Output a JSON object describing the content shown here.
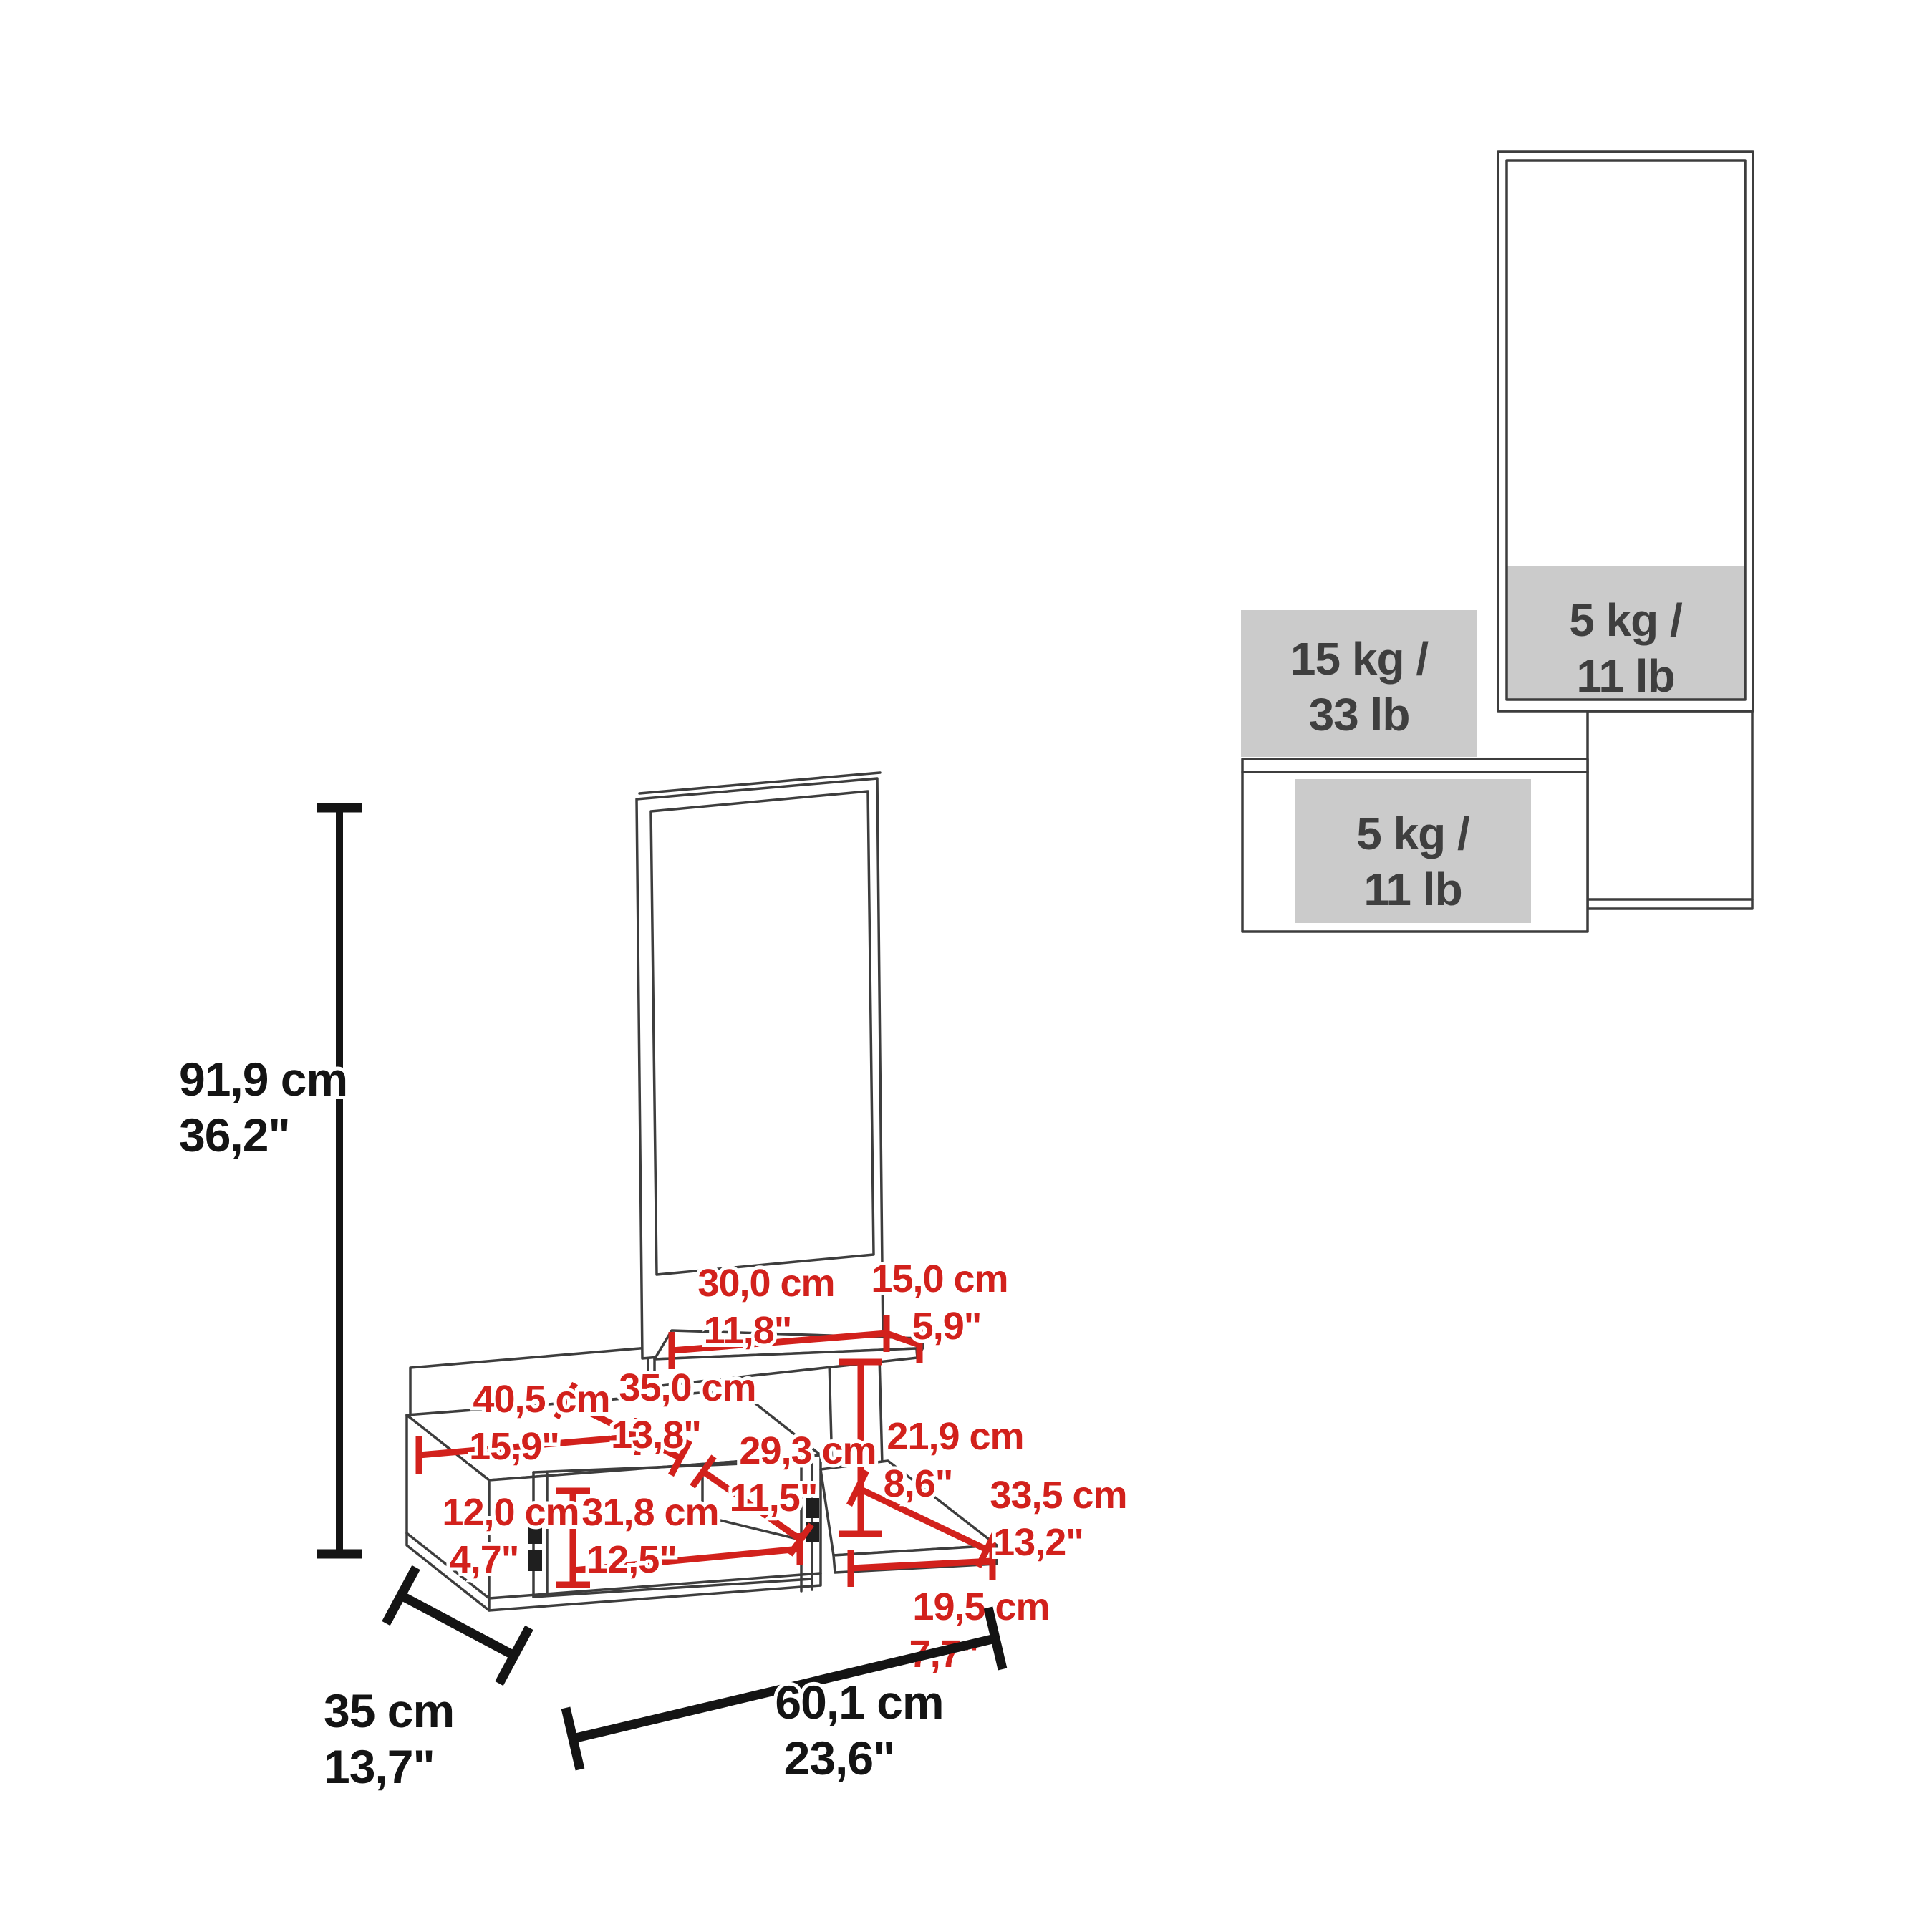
{
  "diagram_type": "furniture dimension diagram",
  "colors": {
    "dimension_red": "#d2211c",
    "outline_gray": "#3d3d3d",
    "dimension_black": "#141414",
    "capacity_gray": "#cbcbcb",
    "capacity_text": "#3f3f3f"
  },
  "main_view": {
    "overall_dimensions": {
      "height": {
        "cm": "91,9 cm",
        "in": "36,2\""
      },
      "depth": {
        "cm": "35 cm",
        "in": "13,7\""
      },
      "width": {
        "cm": "60,1 cm",
        "in": "23,6\""
      }
    },
    "partial_dimensions": {
      "shelf_left": {
        "cm": "30,0 cm",
        "in": "11,8\""
      },
      "shelf_right": {
        "cm": "15,0 cm",
        "in": "5,9\""
      },
      "top_width": {
        "cm": "40,5 cm",
        "in": "15,9\""
      },
      "top_depth": {
        "cm": "35,0 cm",
        "in": "13,8\""
      },
      "interior_depth": {
        "cm": "29,3 cm",
        "in": "11,5\""
      },
      "shelf_clearance": {
        "cm": "21,9 cm",
        "in": "8,6\""
      },
      "base_depth": {
        "cm": "33,5 cm",
        "in": "13,2\""
      },
      "door_height": {
        "cm": "12,0 cm",
        "in": "4,7\""
      },
      "interior_width": {
        "cm": "31,8 cm",
        "in": "12,5\""
      },
      "base_width": {
        "cm": "19,5 cm",
        "in": "7,7\""
      }
    }
  },
  "load_view": {
    "mirror_shelf_capacity": {
      "line1": "5 kg /",
      "line2": "11 lb"
    },
    "top_surface_capacity": {
      "line1": "15 kg /",
      "line2": "33 lb"
    },
    "drawer_capacity": {
      "line1": "5 kg /",
      "line2": "11 lb"
    }
  }
}
